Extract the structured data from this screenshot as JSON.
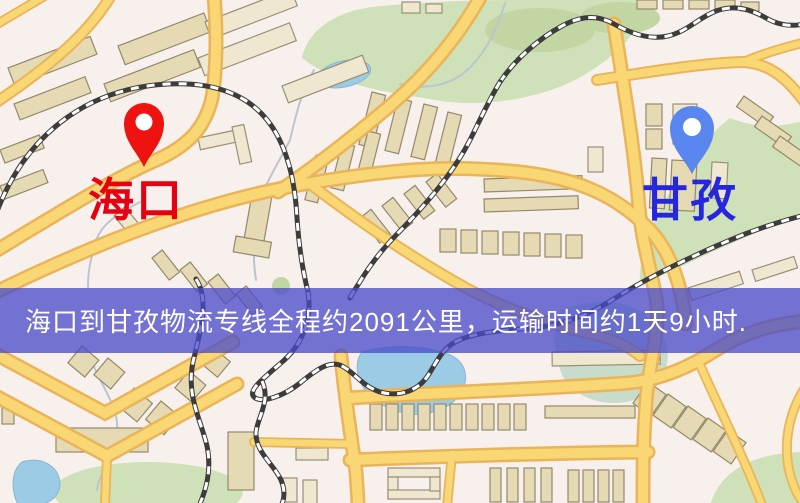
{
  "banner": {
    "text": "海口到甘孜物流专线全程约2091公里，运输时间约1天9小时.",
    "background_color": "#484acb",
    "text_color": "#ffffff"
  },
  "labels": {
    "origin": {
      "text": "海口",
      "color": "#e60012"
    },
    "destination": {
      "text": "甘孜",
      "color": "#2626dd"
    }
  },
  "pins": {
    "origin": {
      "color": "#ee1310"
    },
    "destination": {
      "color": "#5a86ef"
    }
  },
  "route": {
    "origin": "海口",
    "destination": "甘孜",
    "distance_text": "约2091公里",
    "duration_text": "约1天9小时"
  },
  "map_palette": {
    "background": "#f8f0ec",
    "road_fill": "#f8d774",
    "road_casing": "#eab45a",
    "building": "#e5dab3",
    "park": "#cfe1b8",
    "water": "#9ccbe6",
    "railway": "#3c3c3c"
  }
}
